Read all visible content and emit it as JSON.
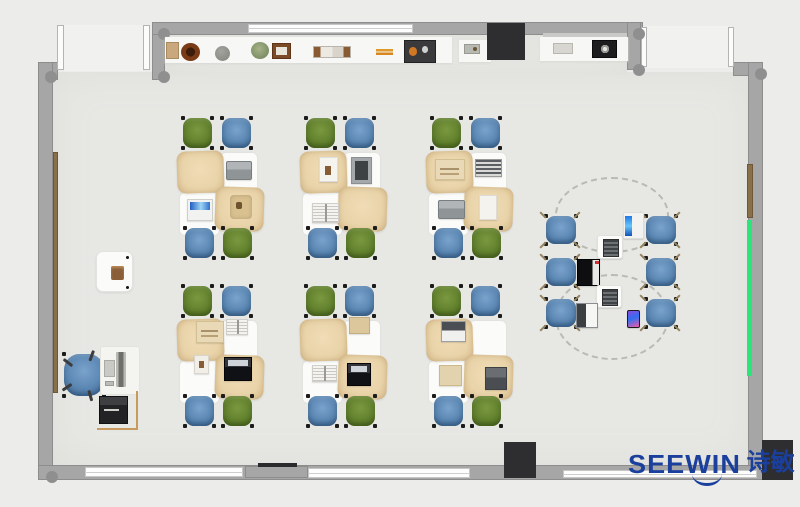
{
  "logo": {
    "brand": "SEEWIN",
    "brand_cn": "诗敏",
    "color": "#1b3f9c",
    "pos": [
      628,
      451
    ]
  },
  "colors": {
    "background": "#ececeb",
    "floor": "#e7e7e4",
    "wall": "#a6a6a6",
    "pillar": "#2e2e30",
    "chair_green": "#63822e",
    "chair_blue": "#5b87b3",
    "desk_tan": "#e9d3a9",
    "board_brown": "#8a6f4b",
    "board_green": "#2be57b",
    "logo_blue": "#1b3f9c"
  },
  "room": {
    "floor_rects": [
      [
        53,
        72,
        697,
        393
      ],
      [
        165,
        35,
        462,
        40
      ]
    ],
    "door_openings": [
      [
        64,
        25,
        79,
        46
      ],
      [
        647,
        26,
        81,
        42
      ]
    ],
    "walls": [
      [
        152,
        22,
        13,
        58
      ],
      [
        152,
        22,
        491,
        13
      ],
      [
        627,
        22,
        14,
        48
      ],
      [
        733,
        62,
        30,
        14
      ],
      [
        748,
        62,
        15,
        418
      ],
      [
        38,
        62,
        20,
        18
      ],
      [
        38,
        62,
        15,
        418
      ],
      [
        38,
        465,
        725,
        15
      ],
      [
        245,
        466,
        63,
        12
      ]
    ],
    "windows": [
      [
        248,
        24,
        165,
        9
      ],
      [
        85,
        467,
        158,
        10
      ],
      [
        308,
        468,
        162,
        10
      ],
      [
        563,
        470,
        194,
        8
      ]
    ],
    "door_frames": [
      [
        57,
        25,
        7,
        45
      ],
      [
        143,
        25,
        7,
        45
      ],
      [
        641,
        27,
        6,
        40
      ],
      [
        728,
        27,
        6,
        40
      ]
    ],
    "pillars": [
      [
        487,
        23,
        38,
        37
      ],
      [
        504,
        442,
        32,
        36
      ],
      [
        762,
        440,
        31,
        40
      ]
    ],
    "beams": [
      [
        258,
        463,
        39,
        4
      ]
    ],
    "corner_dots": [
      [
        45,
        71
      ],
      [
        158,
        28
      ],
      [
        158,
        71
      ],
      [
        633,
        28
      ],
      [
        633,
        64
      ],
      [
        755,
        68
      ],
      [
        46,
        471
      ]
    ],
    "boards": {
      "left_brown": [
        53,
        152,
        5,
        241
      ],
      "right_brown": [
        747,
        164,
        6,
        54
      ],
      "right_green": [
        747,
        220,
        5,
        156
      ],
      "top_light": [
        543,
        33,
        84,
        7
      ]
    }
  },
  "shelf": {
    "strips": [
      [
        165,
        37,
        287,
        26
      ],
      [
        459,
        40,
        32,
        22
      ],
      [
        540,
        37,
        88,
        24
      ]
    ],
    "items": [
      {
        "t": "box",
        "label": "storage-box",
        "r": [
          166,
          42,
          13,
          17
        ]
      },
      {
        "t": "bowl",
        "label": "dark-bowl",
        "r": [
          181,
          43,
          19,
          18
        ]
      },
      {
        "t": "ball",
        "label": "gray-sphere",
        "r": [
          215,
          46,
          15,
          15
        ]
      },
      {
        "t": "plant",
        "label": "potted-plant",
        "r": [
          251,
          42,
          18,
          17
        ]
      },
      {
        "t": "frame",
        "label": "picture-frame",
        "r": [
          272,
          43,
          19,
          16
        ]
      },
      {
        "t": "books",
        "label": "book-row",
        "r": [
          313,
          46,
          38,
          12
        ]
      },
      {
        "t": "pencils",
        "label": "pencil-pair",
        "r": [
          376,
          49,
          17,
          6
        ]
      },
      {
        "t": "toolbox",
        "label": "tool-box",
        "r": [
          404,
          40,
          32,
          23
        ]
      },
      {
        "t": "gadget",
        "label": "small-gadget",
        "r": [
          464,
          44,
          16,
          10
        ]
      },
      {
        "t": "box2",
        "label": "light-box",
        "r": [
          553,
          43,
          20,
          11
        ]
      },
      {
        "t": "appliance",
        "label": "kettle-unit",
        "r": [
          592,
          40,
          25,
          18
        ]
      }
    ]
  },
  "clusters": {
    "origins": [
      [
        180,
        115
      ],
      [
        303,
        115
      ],
      [
        429,
        115
      ],
      [
        180,
        283
      ],
      [
        303,
        283
      ],
      [
        429,
        283
      ]
    ],
    "chairs": [
      {
        "c": "green",
        "r": [
          2,
          2,
          31,
          32
        ]
      },
      {
        "c": "blue",
        "r": [
          41,
          2,
          31,
          32
        ]
      },
      {
        "c": "blue",
        "r": [
          4,
          112,
          31,
          32
        ]
      },
      {
        "c": "green",
        "r": [
          42,
          112,
          31,
          32
        ]
      }
    ],
    "mats": [
      [
        41,
        38,
        36,
        40
      ],
      [
        0,
        78,
        39,
        42
      ]
    ],
    "desks": [
      {
        "r": [
          -3,
          36,
          47,
          42
        ],
        "rot": -2
      },
      {
        "r": [
          35,
          72,
          49,
          44
        ],
        "rot": 2
      }
    ],
    "items": [
      [
        {
          "t": "laptop-gray",
          "r": [
            46,
            46,
            26,
            19
          ]
        },
        {
          "t": "laptop-blue",
          "r": [
            7,
            84,
            26,
            22
          ]
        },
        {
          "t": "satchel-tan",
          "r": [
            50,
            80,
            22,
            24
          ]
        }
      ],
      [
        {
          "t": "paper-photo",
          "r": [
            16,
            42,
            19,
            25
          ]
        },
        {
          "t": "tablet-dark",
          "r": [
            48,
            42,
            21,
            27
          ]
        },
        {
          "t": "book-open",
          "r": [
            9,
            88,
            27,
            20
          ]
        }
      ],
      [
        {
          "t": "book-open-tan",
          "r": [
            6,
            44,
            30,
            21
          ]
        },
        {
          "t": "book-striped",
          "r": [
            46,
            44,
            27,
            18
          ]
        },
        {
          "t": "laptop-gray",
          "r": [
            9,
            85,
            27,
            19
          ]
        },
        {
          "t": "paper-white",
          "r": [
            50,
            80,
            18,
            25
          ]
        }
      ],
      [
        {
          "t": "book-open-tan",
          "r": [
            16,
            38,
            28,
            22
          ]
        },
        {
          "t": "book-open",
          "r": [
            46,
            36,
            22,
            16
          ]
        },
        {
          "t": "photo-small",
          "r": [
            14,
            72,
            15,
            19
          ]
        },
        {
          "t": "laptop-black-open",
          "r": [
            44,
            74,
            28,
            24
          ]
        }
      ],
      [
        {
          "t": "notebook-tan",
          "r": [
            46,
            34,
            21,
            17
          ]
        },
        {
          "t": "book-open",
          "r": [
            9,
            82,
            25,
            17
          ]
        },
        {
          "t": "laptop-black-open",
          "r": [
            44,
            80,
            24,
            23
          ]
        }
      ],
      [
        {
          "t": "laptop-white-open",
          "r": [
            12,
            38,
            25,
            21
          ]
        },
        {
          "t": "paper-tan",
          "r": [
            10,
            82,
            23,
            21
          ]
        },
        {
          "t": "laptop-dark",
          "r": [
            56,
            84,
            22,
            23
          ]
        }
      ]
    ]
  },
  "collab": {
    "chair_size": [
      32,
      30
    ],
    "chairs": [
      [
        545,
        215
      ],
      [
        545,
        257
      ],
      [
        545,
        298
      ],
      [
        645,
        215
      ],
      [
        645,
        257
      ],
      [
        645,
        298
      ]
    ],
    "ellipses": [
      [
        612,
        215,
        57,
        38
      ],
      [
        612,
        317,
        57,
        43
      ]
    ],
    "devices": [
      {
        "t": "pad-phone-blue",
        "r": [
          623,
          212,
          21,
          27
        ]
      },
      {
        "t": "pad-device",
        "r": [
          597,
          235,
          26,
          24
        ]
      },
      {
        "t": "laptop-black2",
        "r": [
          577,
          259,
          23,
          27
        ]
      },
      {
        "t": "pad-device",
        "r": [
          596,
          285,
          26,
          23
        ]
      },
      {
        "t": "laptop-white2",
        "r": [
          576,
          303,
          22,
          25
        ]
      },
      {
        "t": "phone-x",
        "r": [
          627,
          310,
          13,
          18
        ]
      }
    ]
  },
  "teacher": {
    "side_table": [
      96,
      251,
      37,
      41
    ],
    "side_item": [
      111,
      266,
      13,
      14
    ],
    "side_dots": [
      [
        126,
        256
      ],
      [
        126,
        286
      ]
    ],
    "chair": [
      63,
      353,
      42,
      44
    ],
    "desk": [
      100,
      346,
      40,
      49
    ],
    "monitor": [
      116,
      352,
      10,
      35
    ],
    "tablet": [
      104,
      360,
      11,
      17
    ],
    "keyboard": [
      105,
      381,
      9,
      5
    ],
    "printer": [
      99,
      396,
      29,
      28
    ],
    "l_lines": [
      [
        97,
        428,
        41,
        2
      ],
      [
        136,
        391,
        2,
        39
      ]
    ]
  }
}
